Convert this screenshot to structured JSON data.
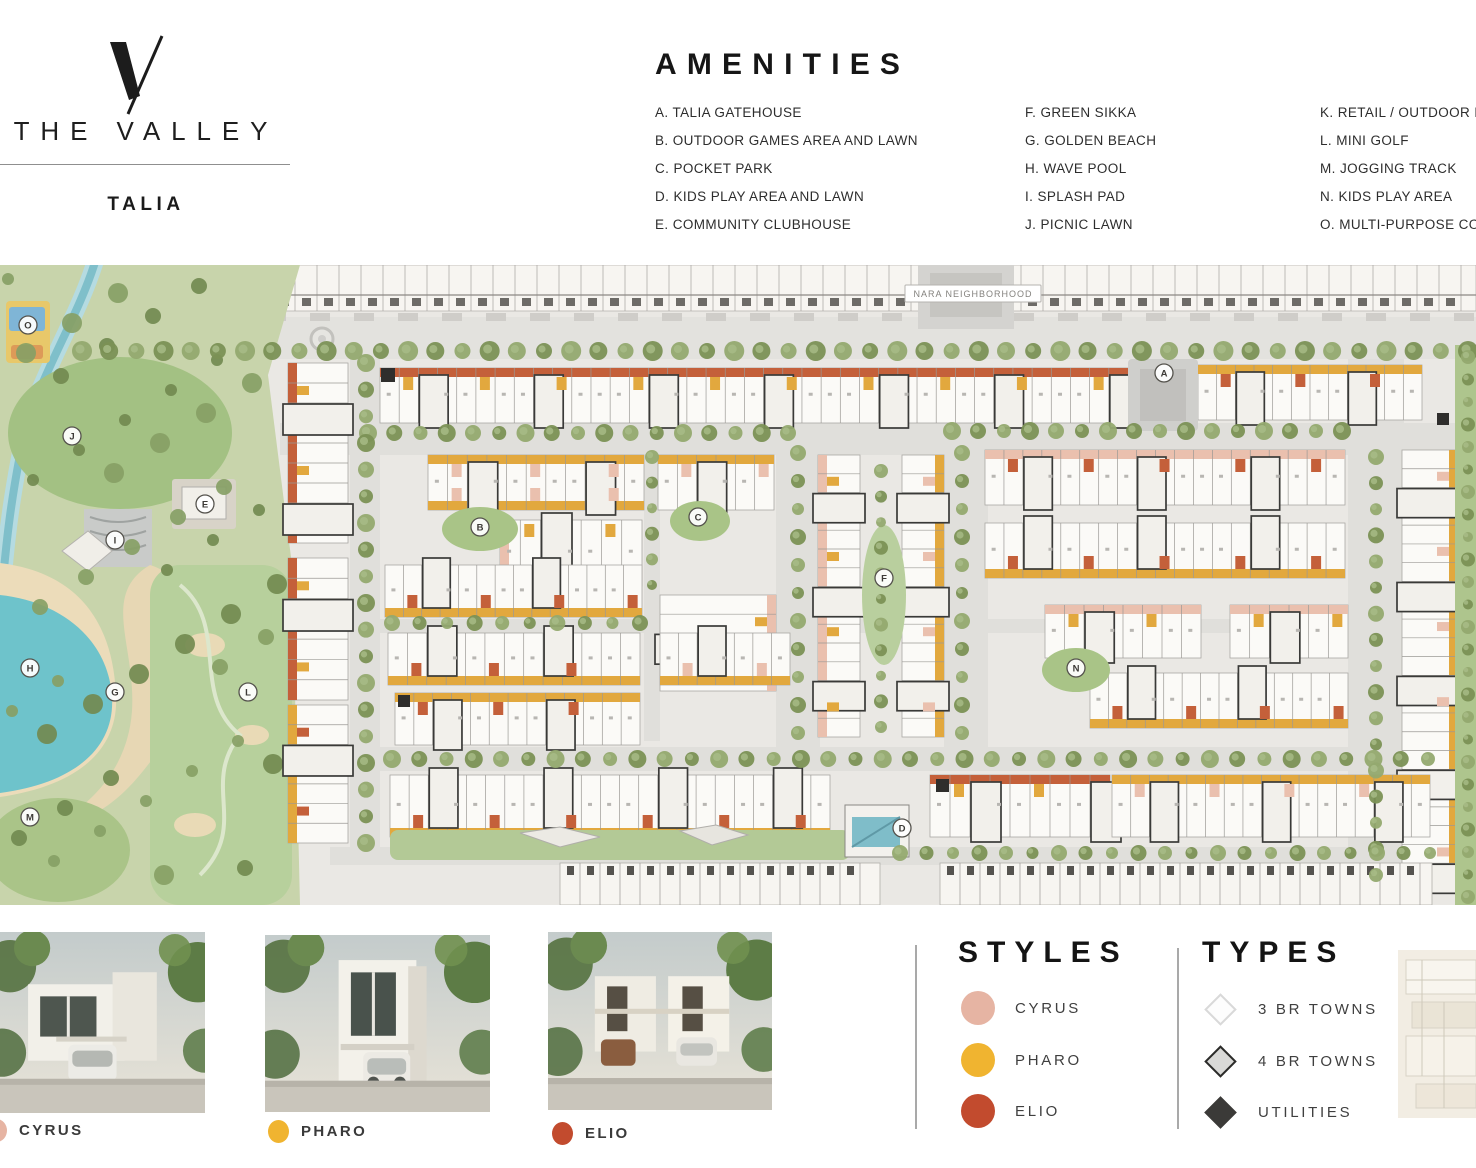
{
  "logo": {
    "brand": "THE VALLEY",
    "community": "TALIA"
  },
  "amenities": {
    "title": "AMENITIES",
    "columns": [
      [
        "A. TALIA GATEHOUSE",
        "B. OUTDOOR GAMES AREA AND LAWN",
        "C. POCKET PARK",
        "D. KIDS PLAY AREA AND LAWN",
        "E. COMMUNITY CLUBHOUSE"
      ],
      [
        "F. GREEN SIKKA",
        "G. GOLDEN BEACH",
        "H. WAVE POOL",
        "I. SPLASH PAD",
        "J. PICNIC LAWN"
      ],
      [
        "K. RETAIL / OUTDOOR D",
        "L. MINI GOLF",
        "M. JOGGING TRACK",
        "N. KIDS PLAY AREA",
        "O. MULTI-PURPOSE COU"
      ]
    ]
  },
  "map": {
    "neighborhood_label": "NARA NEIGHBORHOOD",
    "markers": [
      {
        "letter": "O",
        "x": 28,
        "y": 60
      },
      {
        "letter": "J",
        "x": 72,
        "y": 171
      },
      {
        "letter": "E",
        "x": 205,
        "y": 239
      },
      {
        "letter": "I",
        "x": 115,
        "y": 275
      },
      {
        "letter": "H",
        "x": 30,
        "y": 403
      },
      {
        "letter": "G",
        "x": 115,
        "y": 427
      },
      {
        "letter": "L",
        "x": 248,
        "y": 427
      },
      {
        "letter": "M",
        "x": 30,
        "y": 552
      },
      {
        "letter": "B",
        "x": 480,
        "y": 262
      },
      {
        "letter": "C",
        "x": 698,
        "y": 252
      },
      {
        "letter": "F",
        "x": 884,
        "y": 313
      },
      {
        "letter": "A",
        "x": 1164,
        "y": 108
      },
      {
        "letter": "N",
        "x": 1076,
        "y": 403
      },
      {
        "letter": "D",
        "x": 902,
        "y": 563
      }
    ]
  },
  "map_colors": {
    "cyrus": "#eac0ae",
    "pharo": "#e2a83e",
    "elio": "#c4603a"
  },
  "styles_legend": {
    "title": "STYLES",
    "items": [
      {
        "label": "CYRUS",
        "color": "#e6b4a3"
      },
      {
        "label": "PHARO",
        "color": "#f0b430"
      },
      {
        "label": "ELIO",
        "color": "#c24b2e"
      }
    ]
  },
  "types_legend": {
    "title": "TYPES",
    "items": [
      {
        "label": "3 BR TOWNS",
        "fill": "#fdfdfd",
        "border": "#d9d9d9"
      },
      {
        "label": "4 BR TOWNS",
        "fill": "#d9d9d7",
        "border": "#2b2b29"
      },
      {
        "label": "UTILITIES",
        "fill": "#3b3a38",
        "border": "#3b3a38"
      }
    ]
  },
  "thumbnails": [
    {
      "label": "CYRUS",
      "dot": "#e6b4a3"
    },
    {
      "label": "PHARO",
      "dot": "#f0b430"
    },
    {
      "label": "ELIO",
      "dot": "#c24b2e"
    }
  ]
}
